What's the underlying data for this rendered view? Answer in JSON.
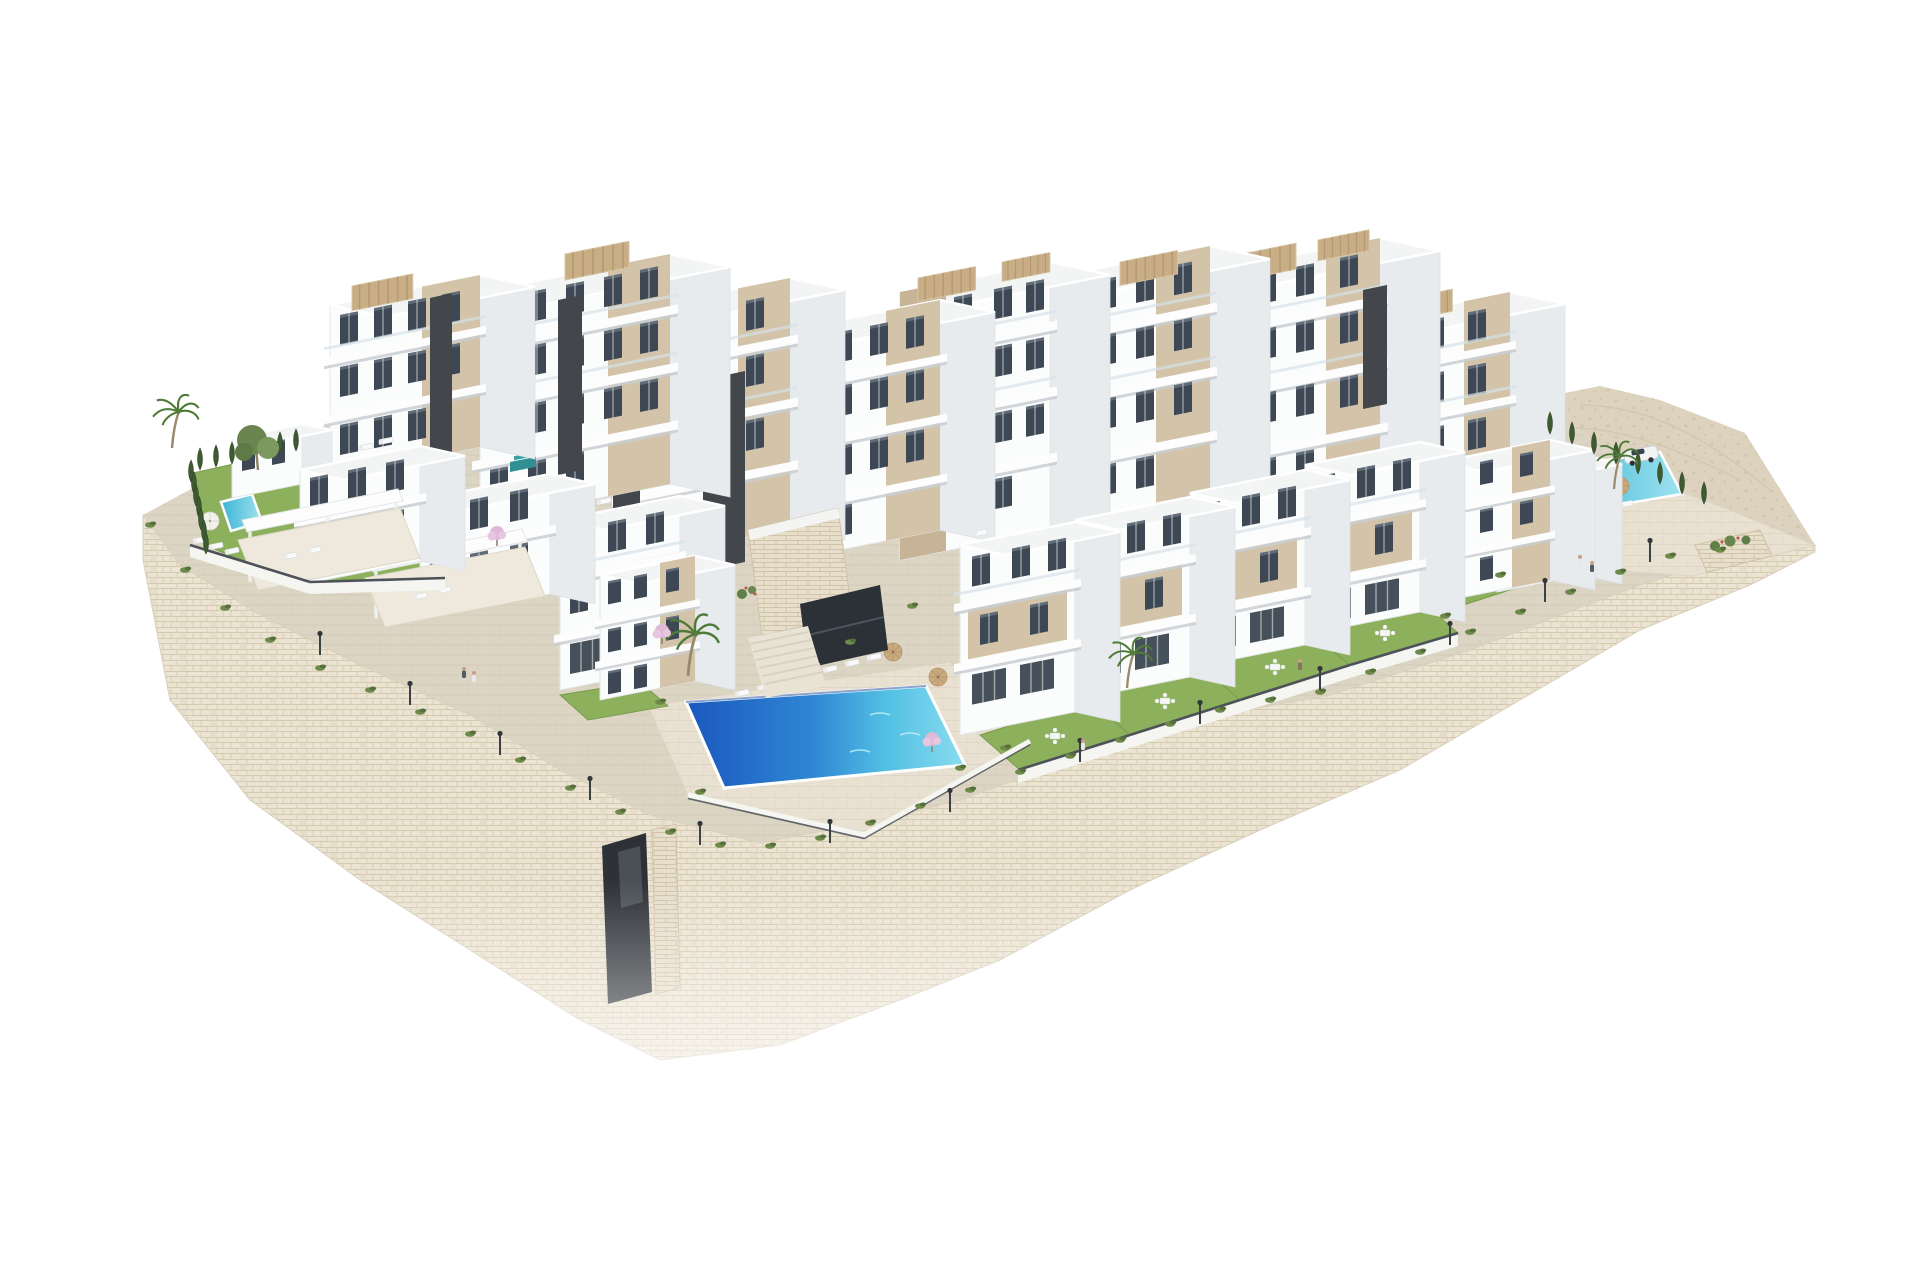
{
  "image": {
    "type": "architectural-3d-render",
    "background": "#ffffff"
  },
  "scene": {
    "title": "Aerial 3D render of a terraced white residential complex with pools",
    "description": "Isometric aerial architectural rendering of a new-build hillside apartment complex: stepped white blocks with beige accent panels, glass balconies and rooftop pergolas, private lawns, a large central community pool with sun loungers and parasols, a small private plunge pool on the left garden, a second community pool with palm trees and a parked white car on the right, all sitting on a terraced stone retaining wall that fades to a white background.",
    "objects": {
      "residential_blocks": 10,
      "townhouses": 6,
      "pools": 3,
      "palm_trees": 4,
      "cypress_trees": 23,
      "street_lamps": 13,
      "sun_loungers": 17,
      "parasols": 6,
      "pedestrians": 6,
      "cars": 1,
      "roof_pergolas": 8,
      "staircases": 2,
      "garage_entrances": 1
    },
    "labels": {
      "central_pool": "central community pool",
      "left_pool": "private plunge pool",
      "right_pool": "east community pool",
      "wall": "stone retaining wall",
      "hill": "rocky hillside",
      "car": "white SUV"
    }
  },
  "palette": {
    "facade-white": "#fbfcfc",
    "facade-shade": "#e8ebed",
    "roof-light": "#f3f4f4",
    "accent-beige": "#d3c3a9",
    "accent-beige-dark": "#c7b395",
    "window-glass": "#3e4854",
    "core-dark": "#43474c",
    "stone-base": "#ece4d3",
    "stone-line": "#d5c9b0",
    "paving": "#ddd5c4",
    "paving-light": "#e8e1d2",
    "hill": "#dcd2be",
    "grass": "#8cb05c",
    "grass-dark": "#6f9048",
    "hedge": "#3d5a30",
    "foliage": "#6b8550",
    "pool-deep": "#1b57be",
    "pool-mid": "#2f86d4",
    "pool-light": "#7fd4ea",
    "pool-small": "#3cb4d6",
    "pergola": "#c9ae85",
    "rail": "#d6e2e8",
    "blossom": "#dfb8d8",
    "car-white": "#f3f4f5"
  }
}
